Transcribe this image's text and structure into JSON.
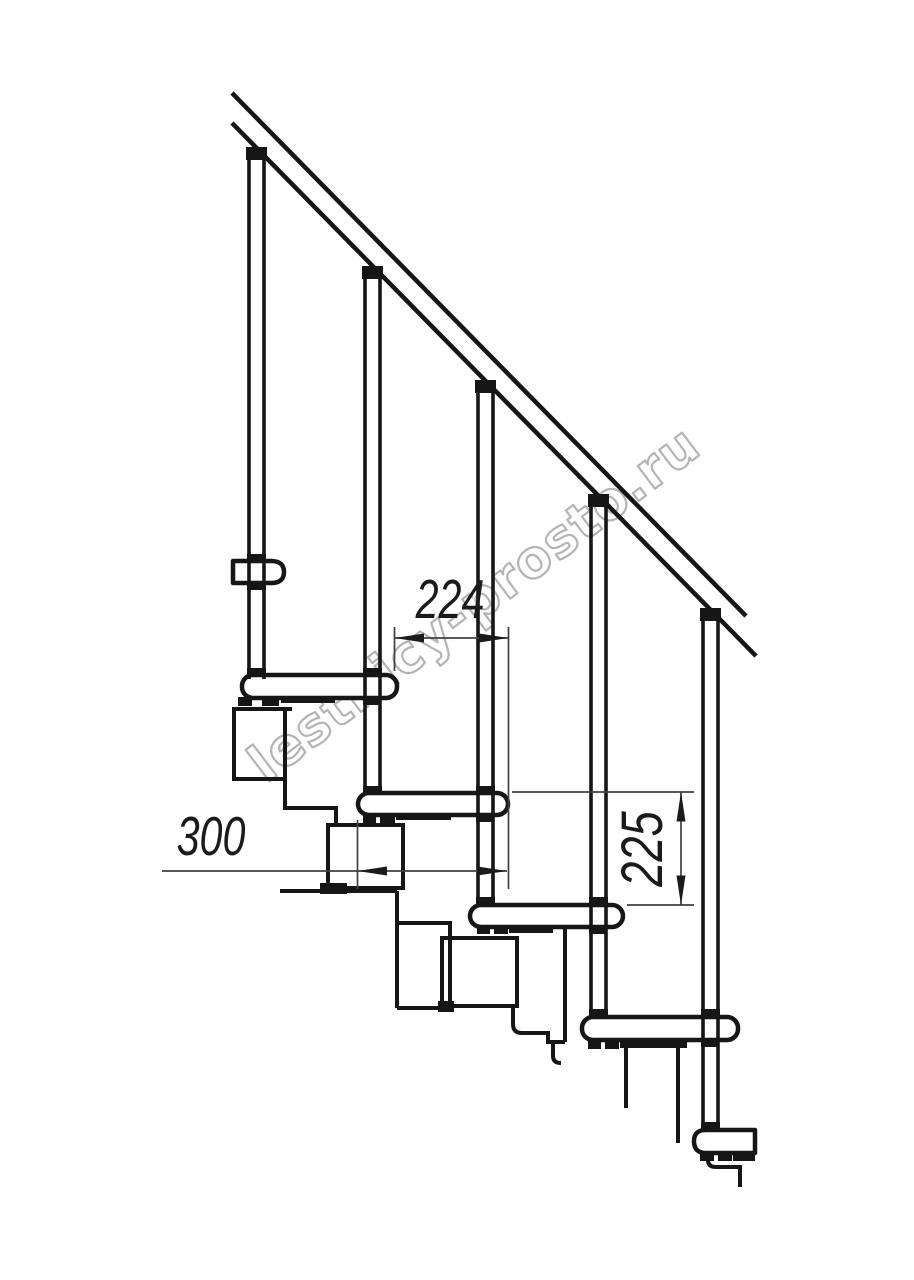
{
  "canvas": {
    "background": "#ffffff"
  },
  "drawing": {
    "kind": "modular-staircase-side-view",
    "line_color": "#161616",
    "dimensions": {
      "line_color": "#404040",
      "text_color": "#1b1b1b",
      "step_run": {
        "value": "224"
      },
      "tread_depth": {
        "value": "300"
      },
      "step_rise": {
        "value": "225"
      }
    },
    "watermark": {
      "text": "lestnicy-prosto.ru",
      "color": "#b4b4b4"
    }
  }
}
